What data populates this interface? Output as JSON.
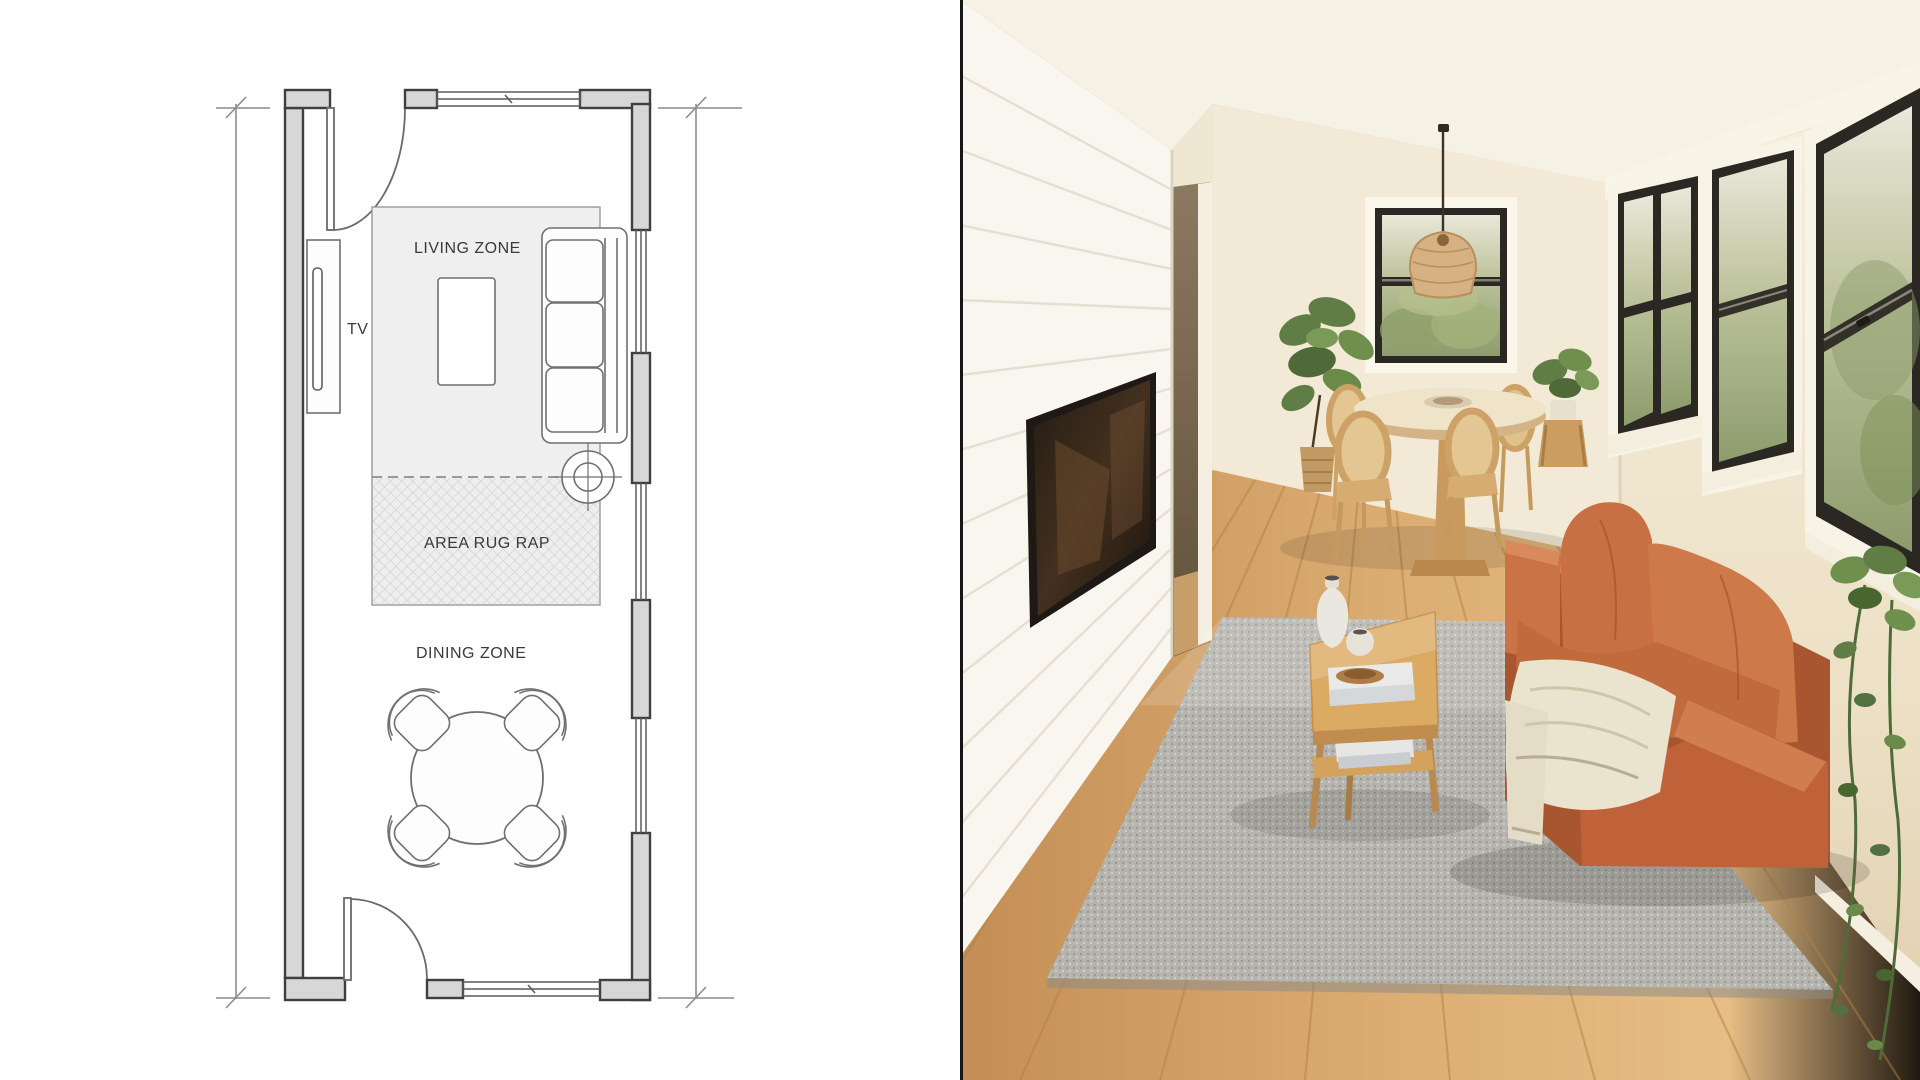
{
  "meta": {
    "title": "Narrow living-dining room: floor plan and styled photo"
  },
  "floor_plan": {
    "labels": {
      "living_zone": "LIVING ZONE",
      "tv": "TV",
      "area_rug": "AREA RUG RAP",
      "dining_zone": "DINING ZONE"
    },
    "colors": {
      "wall_fill": "#d7d7d7",
      "wall_outline": "#3f3f3f",
      "furniture_line": "#707070",
      "rug_fill": "#efefef",
      "dimension_line": "#8c8c8c",
      "text": "#3a3a3a"
    }
  },
  "photo": {
    "colors": {
      "ceiling": "#f6f1e5",
      "back_wall": "#f2ead7",
      "right_wall": "#f3ecd9",
      "shiplap_wall": "#f8f6ef",
      "floor": "#d7a76e",
      "rug": "#b5b4ae",
      "sofa": "#c06a3e",
      "sofa_shadow": "#a85630",
      "throw_blanket": "#eae3cd",
      "window_frame": "#2b2823",
      "window_trim": "#f8f4e7",
      "glass_foliage": "#9fae7c",
      "wood_furniture": "#d3a562",
      "pendant_rattan": "#d6b183",
      "plant_green": "#5f7d45",
      "tv_screen": "#1f1915"
    }
  }
}
